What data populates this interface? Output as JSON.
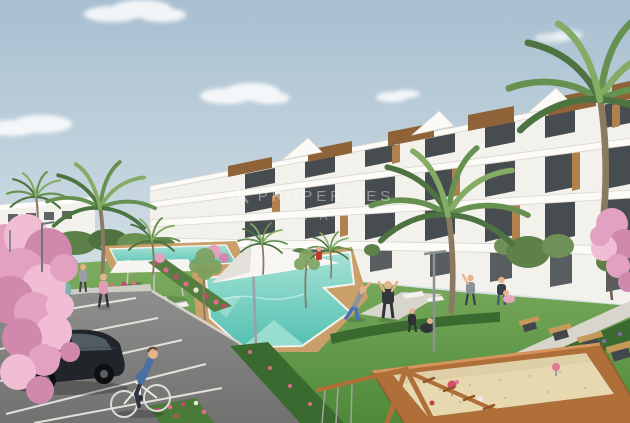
{
  "meta": {
    "type": "architectural-render",
    "subject": "Modern white apartment complex with turquoise pools, lawns, palm and cherry-blossom trees, parking lot with black car, cyclist, benches and a playground sandbox"
  },
  "watermark": {
    "mark": "XA",
    "line1": "PROPERTIES",
    "line2": "SPAIN"
  },
  "palette": {
    "sky_top": "#a8bfd0",
    "sky_mid": "#ccdae2",
    "sky_horizon": "#e9ebe7",
    "cloud": "#ffffff",
    "building_face": "#f3f1ec",
    "building_slab": "#fcfbf8",
    "building_shadow": "#d9d5cc",
    "window_glass": "#474c51",
    "wood": "#b0814c",
    "wood_dark": "#8d6337",
    "palm_dark": "#4c7340",
    "palm_mid": "#669150",
    "palm_light": "#84ac64",
    "trunk": "#8a7a64",
    "grass_far": "#7ead60",
    "grass_near": "#4e8939",
    "hedge": "#3b6a30",
    "blossom_light": "#f0bdd4",
    "blossom_mid": "#e2a1c0",
    "blossom_deep": "#d089ad",
    "pool_light": "#a5e2d6",
    "pool_deep": "#53c1b1",
    "deck": "#c9a069",
    "path": "#d8d5cc",
    "asphalt": "#8e8e8c",
    "asphalt_dark": "#717170",
    "marking": "#eceae6",
    "sand": "#e7d8b0",
    "frame_wood": "#b06f38",
    "frame_wood_light": "#d6955c",
    "car_body": "#212529",
    "bench_dark": "#43464a",
    "bench_seat": "#c59a58",
    "skin": "#e6b28c",
    "flower_pink": "#e06a88",
    "flower_red": "#c2496b",
    "flower_purple": "#8a68b0"
  },
  "scene": {
    "objects": [
      {
        "name": "sky",
        "desc": "pale blue sky with soft clouds"
      },
      {
        "name": "apartment-building",
        "desc": "stepped 3-4 storey white block rising left to right, dark glazing, wood accents, rooftop wood boxes"
      },
      {
        "name": "palm-trees",
        "desc": "six palms, large one center and right edge"
      },
      {
        "name": "cherry-blossom-trees",
        "desc": "pink blossom trees left edge and right edge"
      },
      {
        "name": "swimming-pool-main",
        "desc": "turquoise geometric pool with tan wood deck"
      },
      {
        "name": "swimming-pool-far",
        "desc": "second smaller pool behind"
      },
      {
        "name": "shade-sail",
        "desc": "white sail on mast over deck"
      },
      {
        "name": "shade-canopy",
        "desc": "white flat canopy on posts"
      },
      {
        "name": "parking-lot",
        "desc": "gray asphalt with white angled stalls"
      },
      {
        "name": "black-hatchback-car",
        "desc": "black hatchback parked"
      },
      {
        "name": "parked-sedan",
        "desc": "dark sedan in far row"
      },
      {
        "name": "cyclist",
        "desc": "man in blue sweater riding bicycle"
      },
      {
        "name": "pedestrians",
        "desc": "walkers on path, people exercising, kids playing, seated figure"
      },
      {
        "name": "benches",
        "desc": "four dark benches with wood seats along path"
      },
      {
        "name": "sandbox",
        "desc": "large wood-framed sandbox with spring riders"
      },
      {
        "name": "wooden-swing-frame",
        "desc": "timber swing A-frame with chains, foreground"
      },
      {
        "name": "street-lamps",
        "desc": "slim gray light poles"
      },
      {
        "name": "flower-beds",
        "desc": "pink, red and purple flower strips"
      }
    ]
  }
}
